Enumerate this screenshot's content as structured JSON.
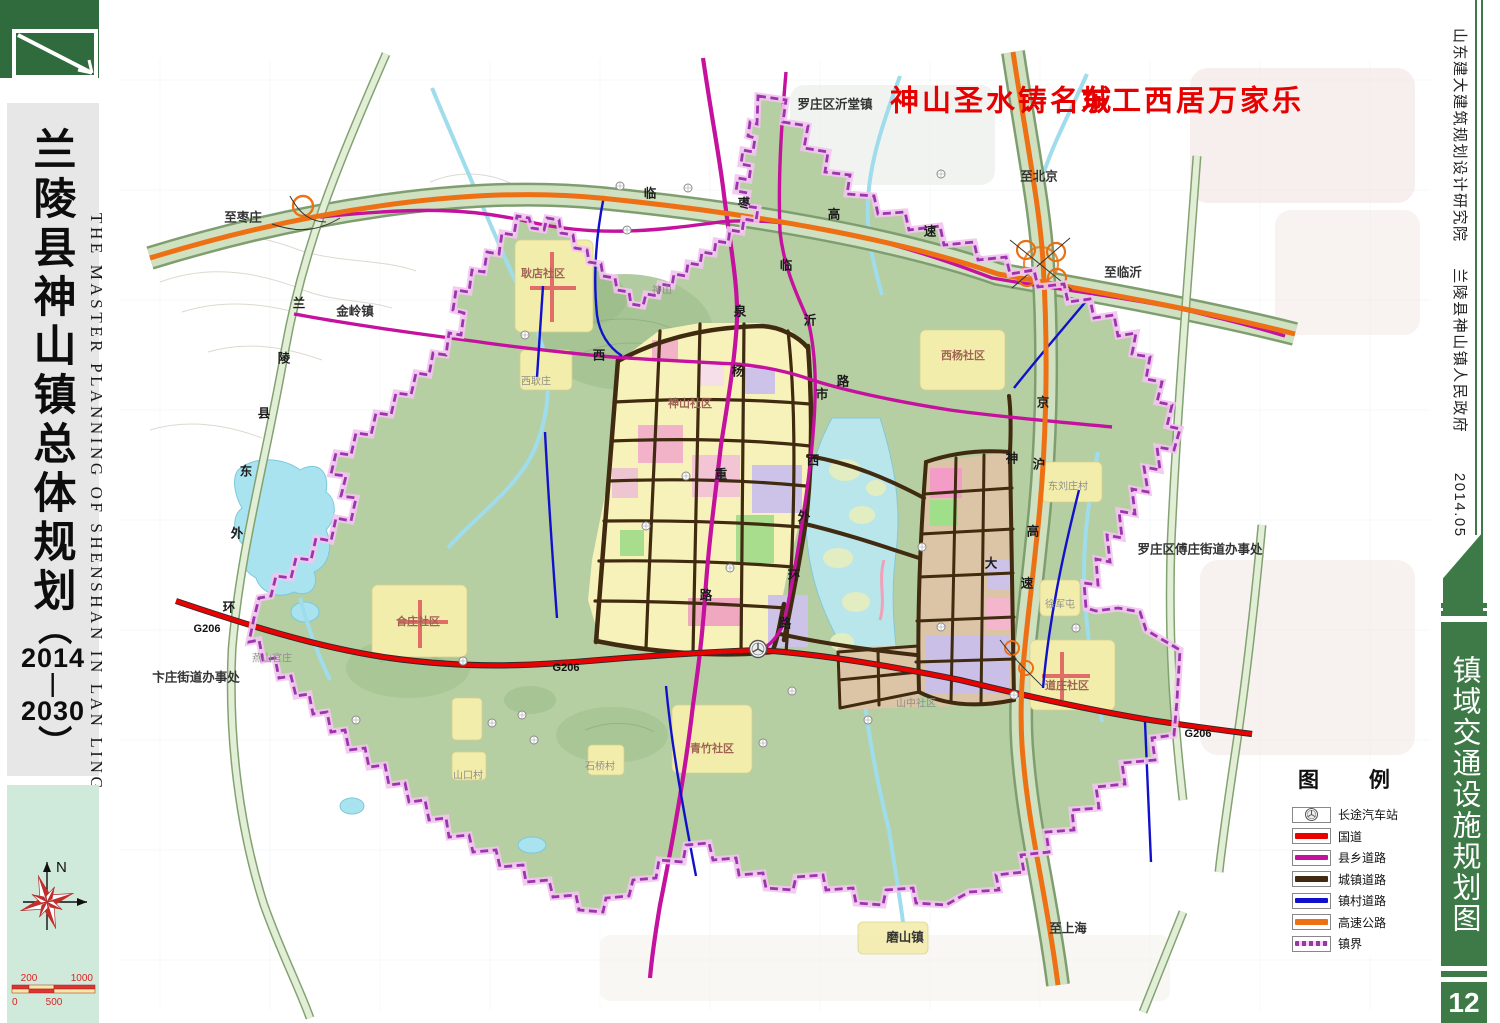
{
  "left_panel": {
    "title_cn": "兰陵县神山镇总体规划",
    "paren_open": "（",
    "year_start": "2014",
    "year_dash": "—",
    "year_end": "2030",
    "paren_close": "）",
    "title_en": "THE MASTER PLANNING OF SHENSHAN IN LAN LING",
    "compass_north": "N",
    "scalebar": {
      "l0": "0",
      "l200": "200",
      "l500": "500",
      "l1000": "1000"
    }
  },
  "right_panel": {
    "institute": "山东建大建筑规划设计研究院",
    "government": "兰陵县神山镇人民政府",
    "date": "2014.05",
    "sheet_title": "镇域交通设施规划图",
    "page_number": "12"
  },
  "slogan": {
    "part1": "神山圣水铸名城",
    "part2": "东工西居万家乐"
  },
  "legend": {
    "title": "图 例",
    "items": [
      {
        "label": "长途汽车站",
        "type": "bus-station"
      },
      {
        "label": "国道",
        "color": "#e80202"
      },
      {
        "label": "县乡道路",
        "color": "#c4119e"
      },
      {
        "label": "城镇道路",
        "color": "#402a10"
      },
      {
        "label": "镇村道路",
        "color": "#1111cc"
      },
      {
        "label": "高速公路",
        "color": "#ed7014"
      },
      {
        "label": "镇界",
        "color": "#9b35ad",
        "style": "dashed"
      }
    ]
  },
  "colors": {
    "sidebar_green": "#2f6b3c",
    "bar_green": "#3d7a47",
    "panel_gray": "#e7e7e7",
    "panel_teal": "#cfe9db",
    "town_green": "#b5cfa2",
    "water": "#a9e3f0",
    "national_road": "#e80202",
    "county_road": "#c4119e",
    "town_road": "#402a10",
    "village_road": "#1111cc",
    "expressway": "#ed7014",
    "boundary": "#9b35ad",
    "slogan_red": "#e60000"
  },
  "map": {
    "labels": [
      {
        "text": "罗庄区沂堂镇"
      },
      {
        "text": "至枣庄"
      },
      {
        "text": "金岭镇"
      },
      {
        "text": "至北京"
      },
      {
        "text": "至临沂"
      },
      {
        "text": "卞庄街道办事处"
      },
      {
        "text": "罗庄区傅庄街道办事处"
      },
      {
        "text": "磨山镇"
      },
      {
        "text": "至上海"
      },
      {
        "text": "G206"
      },
      {
        "text": "G206"
      },
      {
        "text": "G206"
      },
      {
        "text": "兰"
      },
      {
        "text": "陵"
      },
      {
        "text": "县"
      },
      {
        "text": "东"
      },
      {
        "text": "外"
      },
      {
        "text": "环"
      },
      {
        "text": "泉"
      },
      {
        "text": "重"
      },
      {
        "text": "路"
      },
      {
        "text": "临"
      },
      {
        "text": "沂"
      },
      {
        "text": "西"
      },
      {
        "text": "外"
      },
      {
        "text": "环"
      },
      {
        "text": "路"
      },
      {
        "text": "西"
      },
      {
        "text": "杨"
      },
      {
        "text": "市"
      },
      {
        "text": "路"
      },
      {
        "text": "临"
      },
      {
        "text": "枣"
      },
      {
        "text": "高"
      },
      {
        "text": "速"
      },
      {
        "text": "京"
      },
      {
        "text": "沪"
      },
      {
        "text": "高"
      },
      {
        "text": "速"
      },
      {
        "text": "神"
      },
      {
        "text": "大"
      },
      {
        "text": "耿店社区"
      },
      {
        "text": "西耿庄"
      },
      {
        "text": "神山"
      },
      {
        "text": "神山社区"
      },
      {
        "text": "西杨社区"
      },
      {
        "text": "合庄社区"
      },
      {
        "text": "燕山官庄"
      },
      {
        "text": "青竹社区"
      },
      {
        "text": "道庄社区"
      },
      {
        "text": "东刘庄村"
      },
      {
        "text": "徐军屯"
      },
      {
        "text": "山中社区"
      },
      {
        "text": "山口村"
      },
      {
        "text": "石桥村"
      }
    ]
  }
}
